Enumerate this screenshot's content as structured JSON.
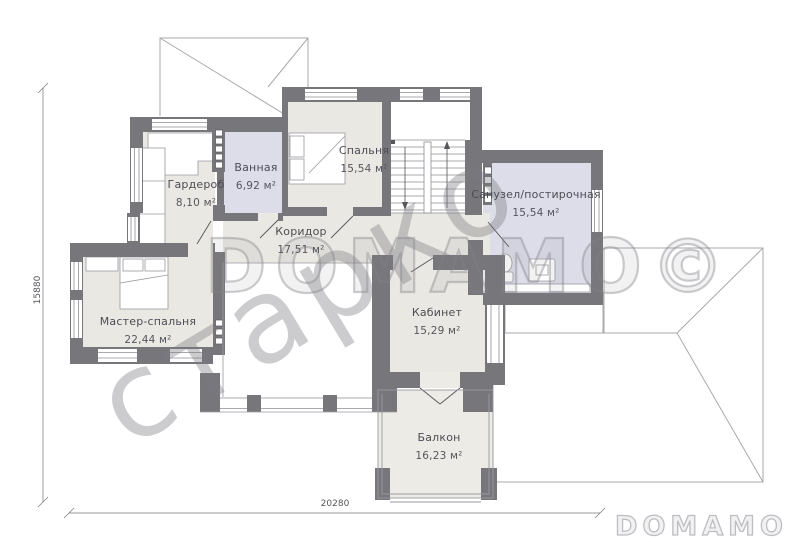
{
  "plan": {
    "rooms": [
      {
        "id": "garderob",
        "name": "Гардероб",
        "area": "8,10 м²"
      },
      {
        "id": "vannaya",
        "name": "Ванная",
        "area": "6,92 м²"
      },
      {
        "id": "spalnya",
        "name": "Спальня",
        "area": "15,54 м²"
      },
      {
        "id": "sanuzel",
        "name": "Санузел/постирочная",
        "area": "15,54 м²"
      },
      {
        "id": "koridor",
        "name": "Коридор",
        "area": "17,51 м²"
      },
      {
        "id": "master",
        "name": "Мастер-спальня",
        "area": "22,44 м²"
      },
      {
        "id": "kabinet",
        "name": "Кабинет",
        "area": "15,29 м²"
      },
      {
        "id": "balkon",
        "name": "Балкон",
        "area": "16,23 м²"
      }
    ],
    "dimensions": {
      "horizontal": "20280",
      "vertical": "15880"
    },
    "watermarks": {
      "diagonal": "старко",
      "horizontal": "DOMAMO©"
    },
    "logo": "DOMAMO",
    "colors": {
      "wall": "#77777b",
      "floor": "#eae8e2",
      "wet_room": "#dcdde8",
      "line": "#9a9aa0"
    }
  }
}
